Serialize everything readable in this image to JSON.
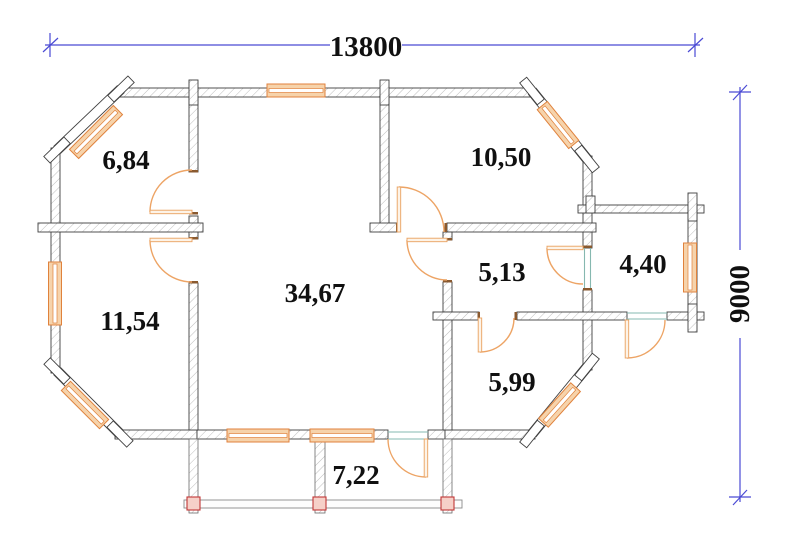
{
  "dimensions": {
    "width": "13800",
    "height": "9000"
  },
  "rooms": [
    {
      "area": "6,84"
    },
    {
      "area": "10,50"
    },
    {
      "area": "11,54"
    },
    {
      "area": "34,67"
    },
    {
      "area": "5,13"
    },
    {
      "area": "4,40"
    },
    {
      "area": "5,99"
    },
    {
      "area": "7,22"
    }
  ],
  "colors": {
    "dimension_line": "#4a4ad4",
    "wall_outline": "#3f3f3f",
    "wall_hatch": "#adadad",
    "window_frame": "#e0823c",
    "window_fill": "#f6d3ab",
    "door": "#eda465",
    "opening_mark": "#86b8b0",
    "porch_marker": "#c23737",
    "label_text": "#101010"
  }
}
